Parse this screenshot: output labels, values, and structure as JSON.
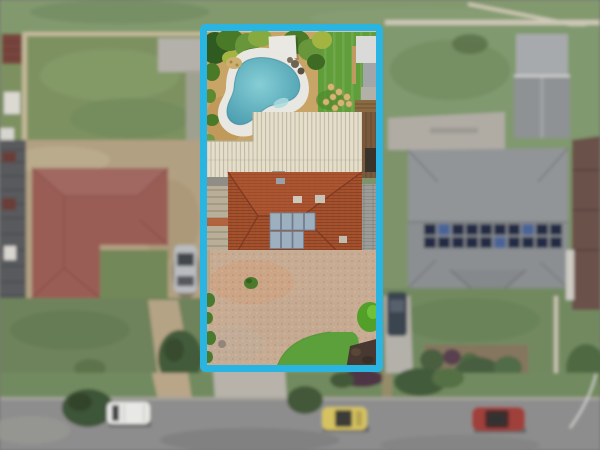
{
  "colors": {
    "boundary": "#29b4e2",
    "road": "#8d8d8d",
    "curb": "#a6a39a",
    "verge_grass": "#6f8b57",
    "field_grass": "#7b9463",
    "backyard_lawn": "#5f9e38",
    "front_lawn": "#5ba03a",
    "pool_water_center": "#86ced6",
    "pool_water_edge": "#4a9cae",
    "pool_coping": "#e9e7e1",
    "pool_sand": "#c9a467",
    "gravel": "#c7ab92",
    "main_roof": "#a5512e",
    "garage_roof": "#e4decb",
    "left_roof": "#a05a50",
    "right_roof": "#8b8f92",
    "far_right_roof": "#6d5047",
    "solar_panel_house": "#9db0c0",
    "solar_panel_neighbor": "#202c48",
    "solar_panel_neighbor_alt": "#44639e",
    "dirt": "#b4a07b",
    "concrete": "#b5b1a8",
    "fence": "#c9bb96",
    "wood_fence": "#7a5a3c",
    "shed_red": "#7d4339",
    "shed_gray": "#a7aaad",
    "mulch": "#473931",
    "tree_dark": "#3f5c33",
    "bush_bright": "#52a029",
    "white_van": "#e8e8e5",
    "yellow_car": "#d9c33c",
    "red_car": "#a83832",
    "gray_car": "#b9bcc0",
    "dark_car": "#3a4450",
    "white_structure": "#e9e8e3"
  }
}
